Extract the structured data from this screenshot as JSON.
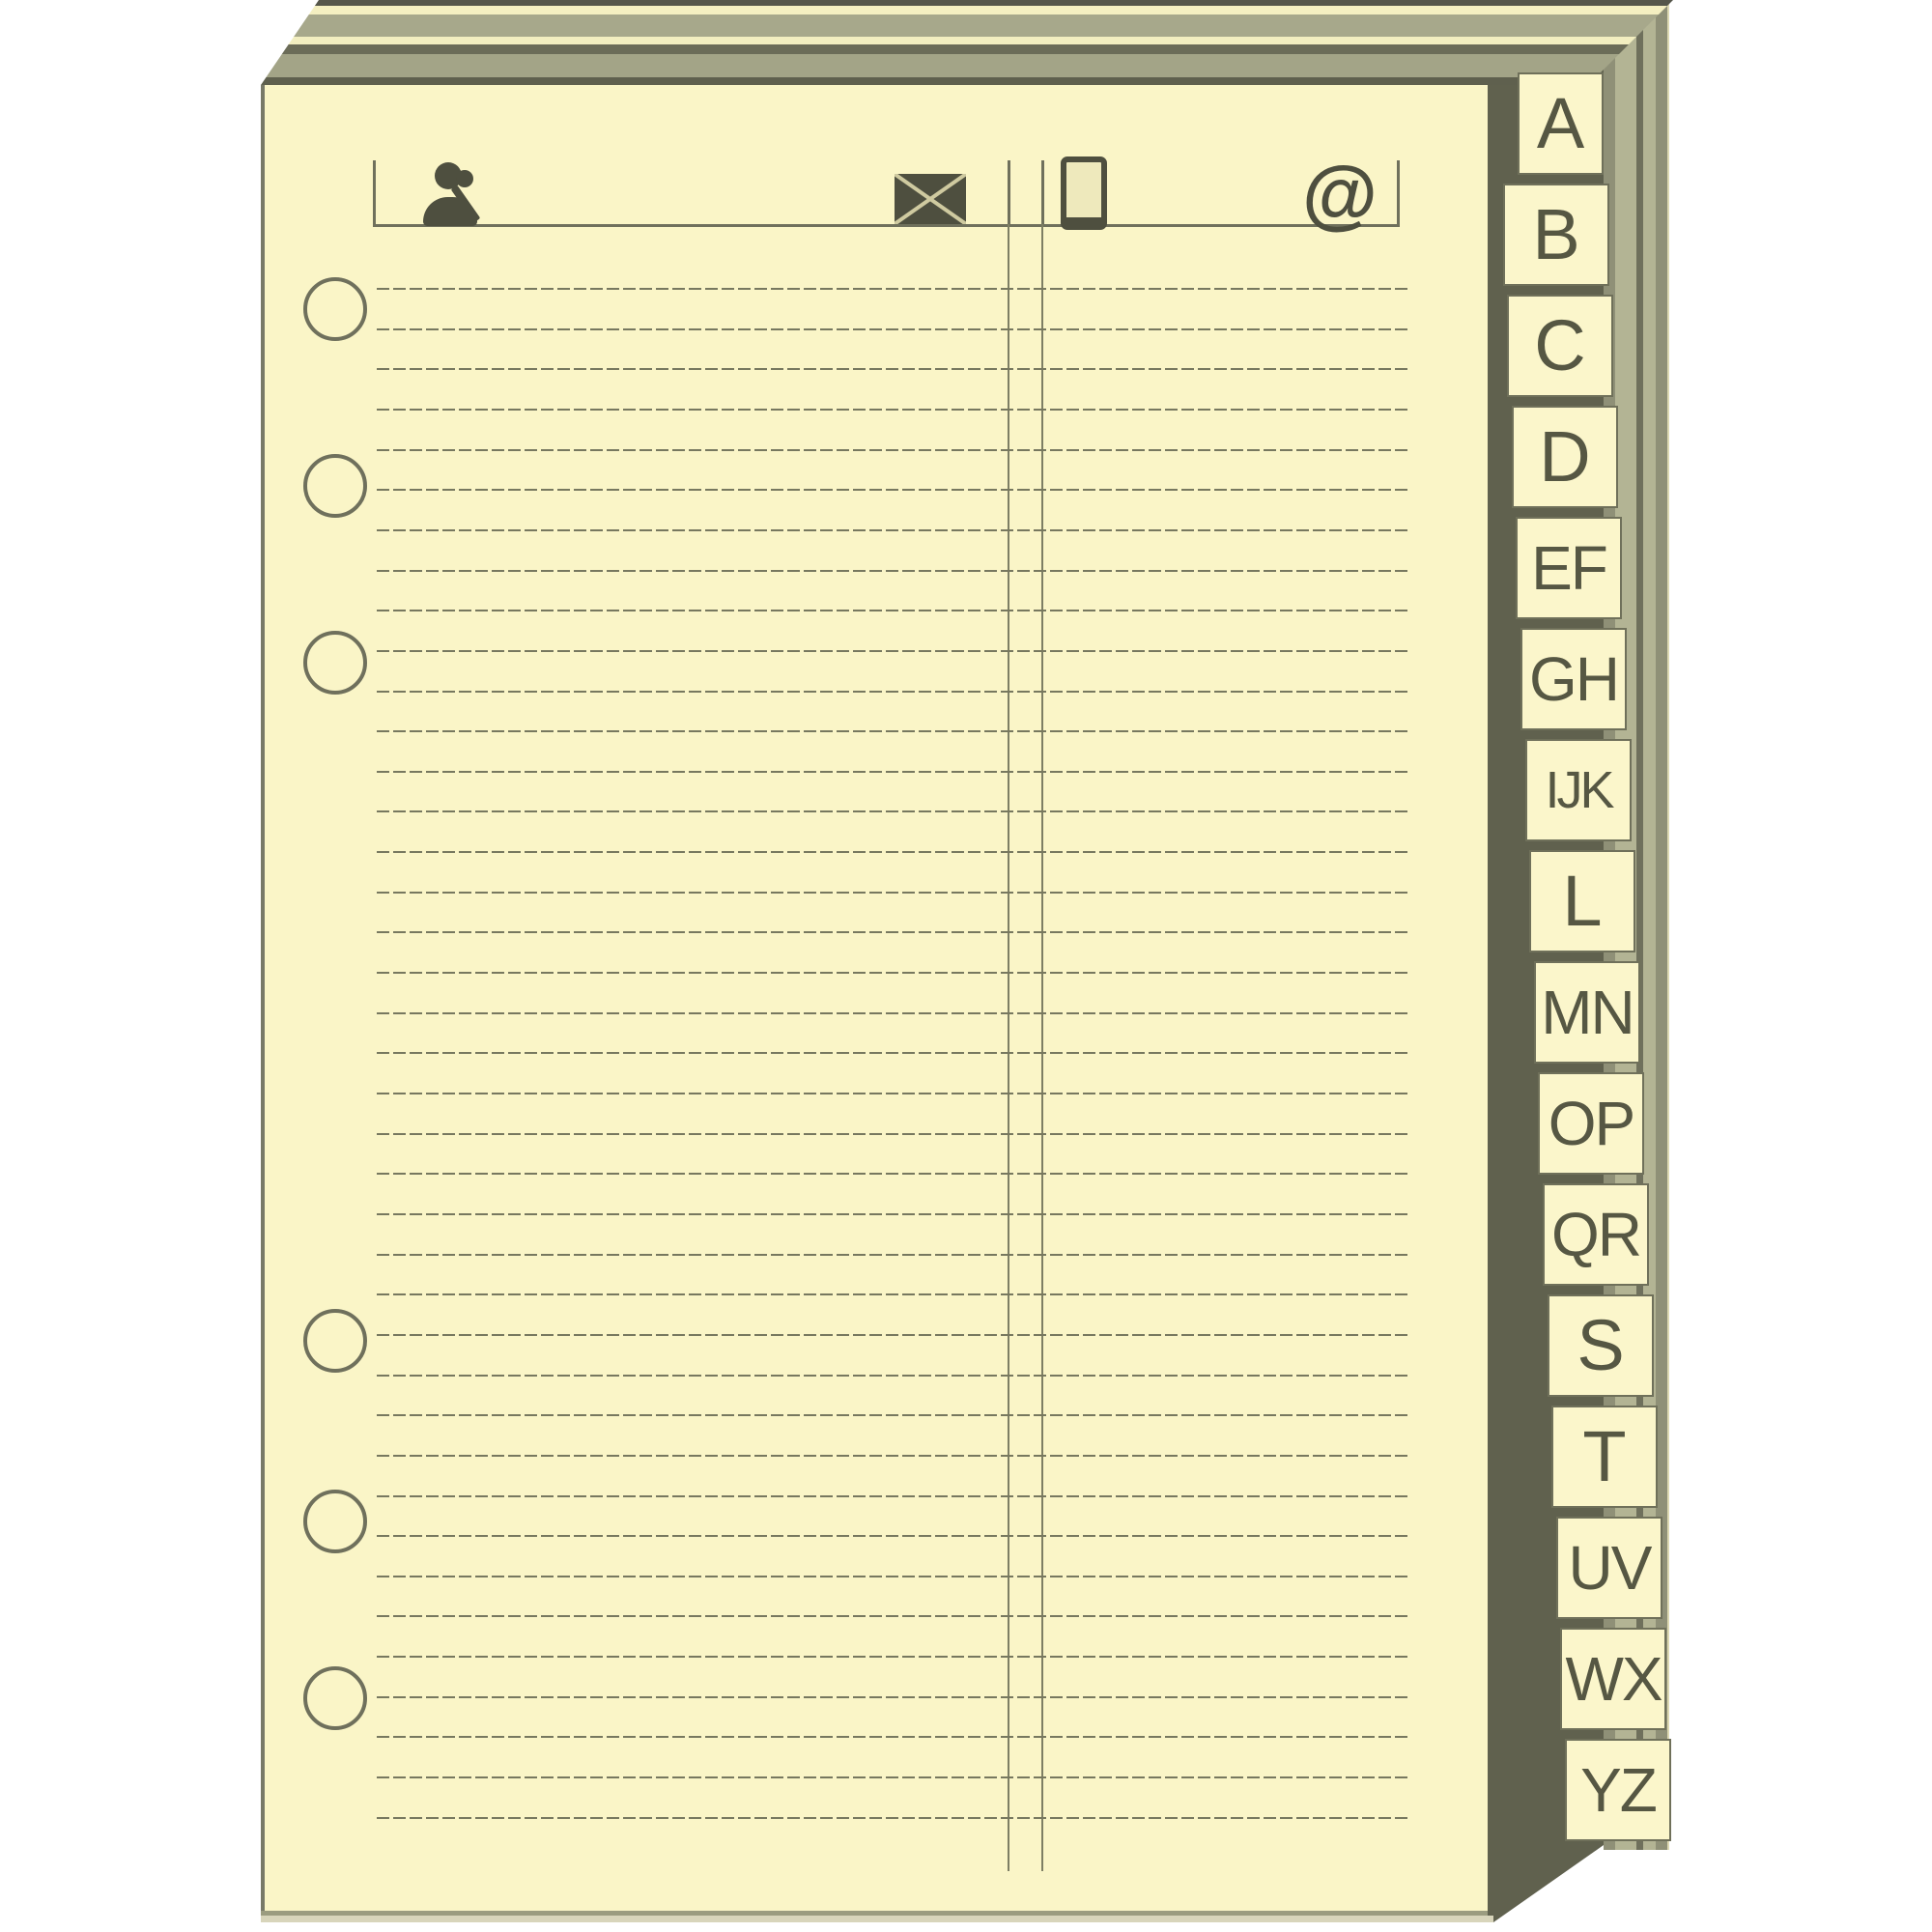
{
  "product": {
    "description": "Cream address-book refill page with alphabetical index tabs",
    "kind": "stationery-product-image"
  },
  "tabs": {
    "items": [
      {
        "label": "A"
      },
      {
        "label": "B"
      },
      {
        "label": "C"
      },
      {
        "label": "D"
      },
      {
        "label": "EF"
      },
      {
        "label": "GH"
      },
      {
        "label": "IJK"
      },
      {
        "label": "L"
      },
      {
        "label": "MN"
      },
      {
        "label": "OP"
      },
      {
        "label": "QR"
      },
      {
        "label": "S"
      },
      {
        "label": "T"
      },
      {
        "label": "UV"
      },
      {
        "label": "WX"
      },
      {
        "label": "YZ"
      }
    ]
  },
  "header": {
    "columns": [
      {
        "icon": "contact-person-icon"
      },
      {
        "icon": "envelope-icon"
      },
      {
        "icon": "mobile-phone-icon"
      },
      {
        "icon": "at-sign-icon",
        "glyph": "@"
      }
    ]
  },
  "page": {
    "hole_count": 6,
    "ruled_line_count": 39,
    "column_divider_lines": 2
  },
  "colors": {
    "paper": "#faf5c7",
    "rule_line": "#77785f",
    "printed_ink": "#4e4f3f",
    "tab_border": "#6f705a",
    "fore_edge_dark": "#60614e",
    "stack_olive": "#9b9c80",
    "stack_cream": "#f4efc1"
  }
}
